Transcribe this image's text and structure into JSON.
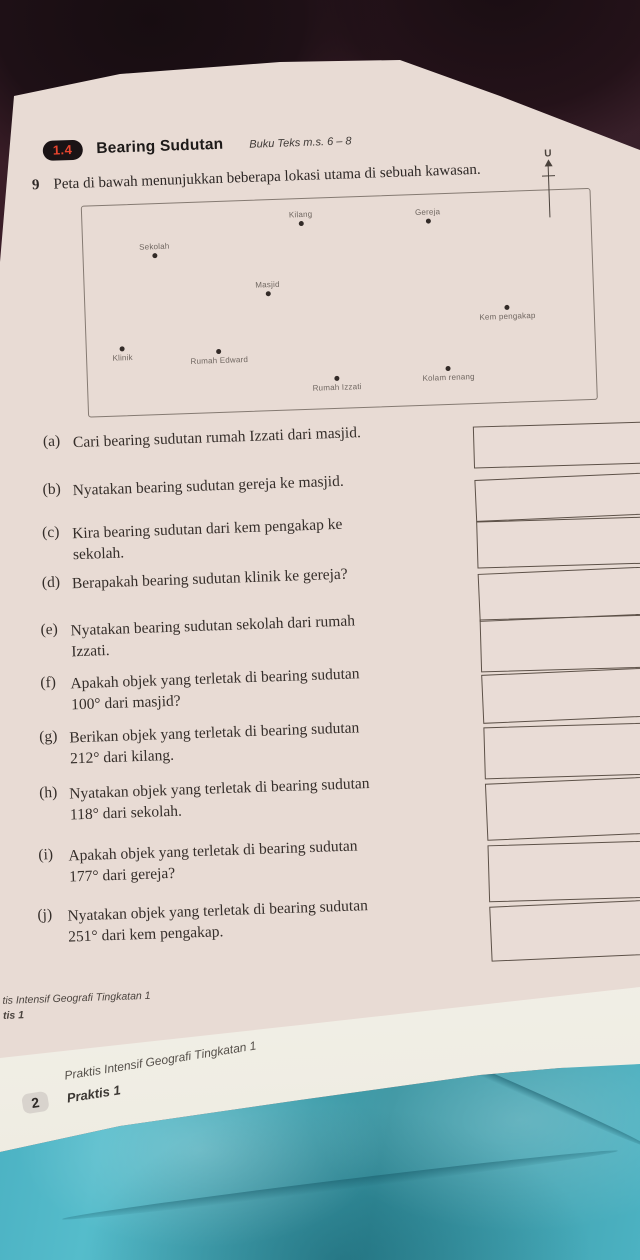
{
  "header": {
    "badge": "1.4",
    "title": "Bearing Sudutan",
    "textbook_ref": "Buku Teks m.s. 6 – 8"
  },
  "intro": {
    "number": "9",
    "text": "Peta di bawah menunjukkan beberapa lokasi utama di sebuah kawasan."
  },
  "map": {
    "north_label": "U",
    "points": [
      {
        "label": "Kilang"
      },
      {
        "label": "Gereja"
      },
      {
        "label": "Sekolah"
      },
      {
        "label": "Masjid"
      },
      {
        "label": "Kem pengakap"
      },
      {
        "label": "Klinik"
      },
      {
        "label": "Rumah Edward"
      },
      {
        "label": "Rumah Izzati"
      },
      {
        "label": "Kolam renang"
      }
    ]
  },
  "questions": [
    {
      "label": "(a)",
      "lines": [
        "Cari bearing sudutan rumah Izzati dari masjid."
      ]
    },
    {
      "label": "(b)",
      "lines": [
        "Nyatakan bearing sudutan gereja ke masjid."
      ]
    },
    {
      "label": "(c)",
      "lines": [
        "Kira bearing sudutan dari kem pengakap ke",
        "sekolah."
      ]
    },
    {
      "label": "(d)",
      "lines": [
        "Berapakah bearing sudutan klinik ke gereja?"
      ]
    },
    {
      "label": "(e)",
      "lines": [
        "Nyatakan bearing sudutan sekolah dari rumah",
        "Izzati."
      ]
    },
    {
      "label": "(f)",
      "lines": [
        "Apakah objek yang terletak di bearing sudutan",
        "100° dari masjid?"
      ]
    },
    {
      "label": "(g)",
      "lines": [
        "Berikan objek yang terletak di bearing sudutan",
        "212° dari kilang."
      ]
    },
    {
      "label": "(h)",
      "lines": [
        "Nyatakan objek yang terletak di bearing sudutan",
        "118° dari sekolah."
      ]
    },
    {
      "label": "(i)",
      "lines": [
        "Apakah objek yang terletak di bearing sudutan",
        "177° dari gereja?"
      ]
    },
    {
      "label": "(j)",
      "lines": [
        "Nyatakan objek yang terletak di bearing sudutan",
        "251° dari kem pengakap."
      ]
    }
  ],
  "footer_page1": {
    "line1": "tis Intensif Geografi Tingkatan 1",
    "line2": "tis 1"
  },
  "page_below": {
    "running_title": "Praktis Intensif Geografi Tingkatan 1",
    "page_number": "2",
    "section": "Praktis 1"
  },
  "colors": {
    "badge_bg": "#1a1315",
    "badge_text": "#e8452f",
    "paper": "#e8dbd4",
    "fabric_top": "#3a1d27",
    "fabric_bottom_teal": "#45aec2"
  }
}
